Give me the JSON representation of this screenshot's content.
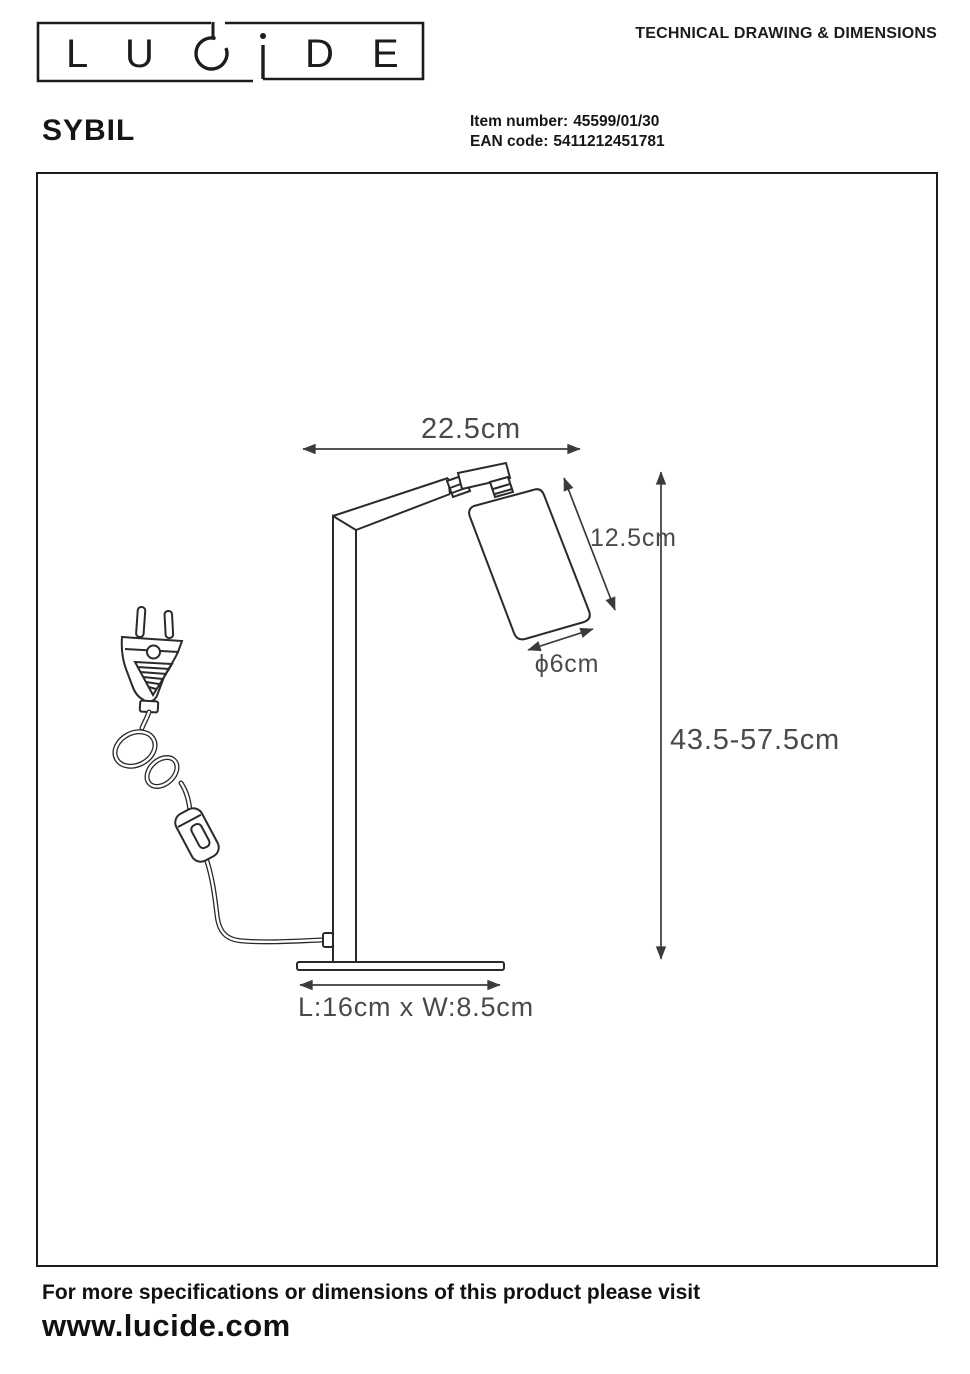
{
  "brand": {
    "letters": [
      "L",
      "U",
      "C",
      "i",
      "D",
      "E"
    ]
  },
  "header": {
    "title": "TECHNICAL DRAWING & DIMENSIONS"
  },
  "product": {
    "name": "SYBIL",
    "item_number_label": "Item number:",
    "item_number_value": "45599/01/30",
    "ean_label": "EAN code:",
    "ean_value": "5411212451781"
  },
  "drawing": {
    "dim_width": "22.5cm",
    "dim_head_length": "12.5cm",
    "dim_head_diameter": "ϕ6cm",
    "dim_height_range": "43.5-57.5cm",
    "dim_base": "L:16cm x W:8.5cm"
  },
  "footer": {
    "line1": "For more specifications or dimensions of this product please visit",
    "line2": "www.lucide.com"
  },
  "colors": {
    "ink": "#2a2a2a",
    "dim_line": "#3b3b3b",
    "dim_text": "#4a4a4a"
  }
}
